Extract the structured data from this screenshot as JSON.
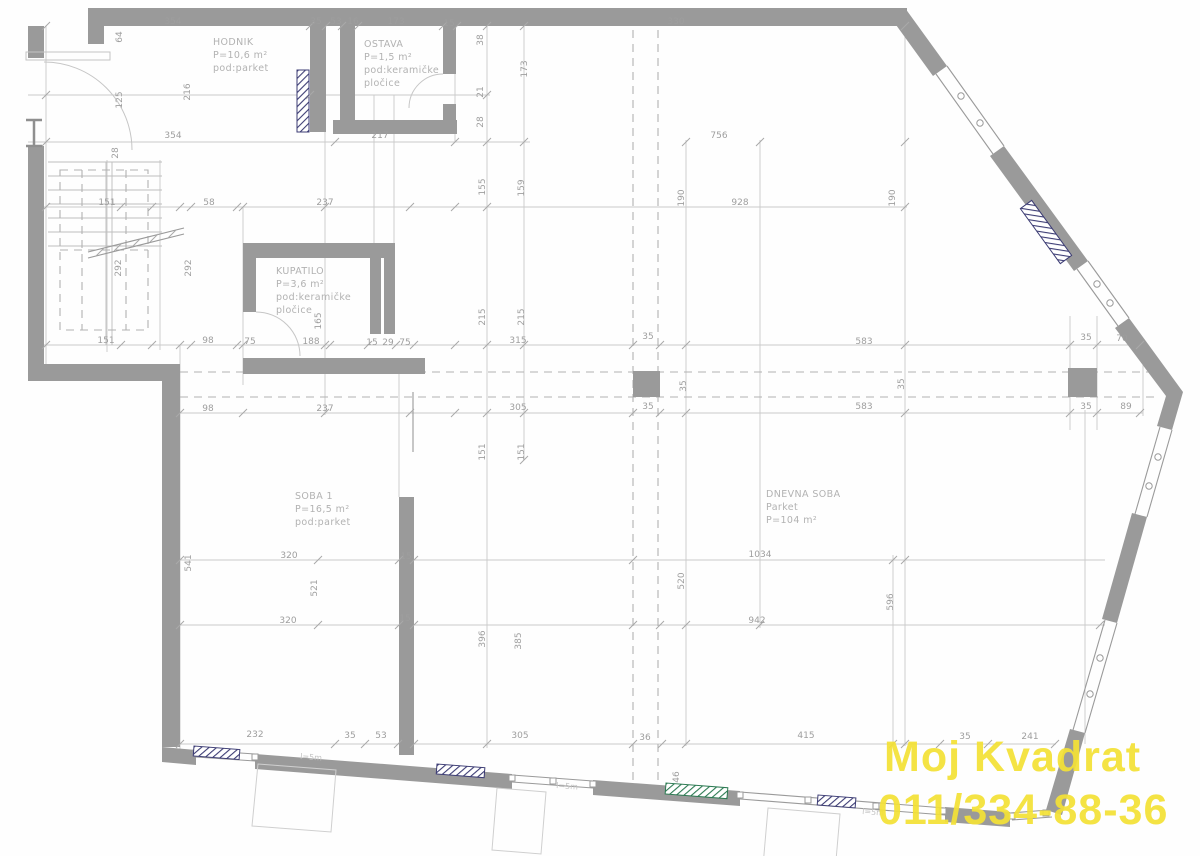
{
  "drawing": {
    "watermark": {
      "line1": "Moj Kvadrat",
      "line2": "011/334-88-36",
      "color": "#f4e136"
    },
    "rooms": [
      {
        "name": "hodnik",
        "x": 213,
        "y": 45,
        "lines": [
          "HODNIK",
          "P=10,6 m²",
          "pod:parket"
        ]
      },
      {
        "name": "ostava",
        "x": 364,
        "y": 47,
        "lines": [
          "OSTAVA",
          "P=1,5 m²",
          "pod:keramičke",
          "pločice"
        ]
      },
      {
        "name": "kupatilo",
        "x": 276,
        "y": 274,
        "lines": [
          "KUPATILO",
          "P=3,6 m²",
          "pod:keramičke",
          "pločice"
        ]
      },
      {
        "name": "soba-1",
        "x": 295,
        "y": 499,
        "lines": [
          "SOBA 1",
          "P=16,5 m²",
          "pod:parket"
        ]
      },
      {
        "name": "dnevna-soba",
        "x": 766,
        "y": 497,
        "lines": [
          "DNEVNA SOBA",
          "Parket",
          "P=104 m²"
        ]
      }
    ],
    "window_labels": [
      {
        "t": "l=5m",
        "x": 300,
        "y": 759,
        "r": 4
      },
      {
        "t": "l=5m",
        "x": 556,
        "y": 788,
        "r": 4
      },
      {
        "t": "l=5m",
        "x": 862,
        "y": 814,
        "r": 4
      }
    ],
    "dimensions": [
      {
        "t": "354",
        "x": 173,
        "y": 24,
        "r": 0
      },
      {
        "t": "35",
        "x": 316,
        "y": 24,
        "r": 0
      },
      {
        "t": "53",
        "x": 336,
        "y": 24,
        "r": 0
      },
      {
        "t": "16",
        "x": 353,
        "y": 24,
        "r": 0
      },
      {
        "t": "173",
        "x": 396,
        "y": 24,
        "r": 0
      },
      {
        "t": "15",
        "x": 449,
        "y": 26,
        "r": 0
      },
      {
        "t": "330",
        "x": 676,
        "y": 24,
        "r": 0
      },
      {
        "t": "64",
        "x": 122,
        "y": 37,
        "r": -90
      },
      {
        "t": "125",
        "x": 122,
        "y": 100,
        "r": -90
      },
      {
        "t": "216",
        "x": 190,
        "y": 92,
        "r": -90
      },
      {
        "t": "28",
        "x": 118,
        "y": 153,
        "r": -90
      },
      {
        "t": "354",
        "x": 173,
        "y": 138,
        "r": 0
      },
      {
        "t": "217",
        "x": 380,
        "y": 138,
        "r": 0
      },
      {
        "t": "756",
        "x": 719,
        "y": 138,
        "r": 0
      },
      {
        "t": "38",
        "x": 483,
        "y": 40,
        "r": -90
      },
      {
        "t": "21",
        "x": 483,
        "y": 92,
        "r": -90
      },
      {
        "t": "28",
        "x": 483,
        "y": 122,
        "r": -90
      },
      {
        "t": "173",
        "x": 527,
        "y": 69,
        "r": -90
      },
      {
        "t": "151",
        "x": 107,
        "y": 205,
        "r": 0
      },
      {
        "t": "58",
        "x": 209,
        "y": 205,
        "r": 0
      },
      {
        "t": "237",
        "x": 325,
        "y": 205,
        "r": 0
      },
      {
        "t": "928",
        "x": 740,
        "y": 205,
        "r": 0
      },
      {
        "t": "190",
        "x": 684,
        "y": 198,
        "r": -90
      },
      {
        "t": "190",
        "x": 895,
        "y": 198,
        "r": -90
      },
      {
        "t": "292",
        "x": 121,
        "y": 268,
        "r": -90
      },
      {
        "t": "292",
        "x": 191,
        "y": 268,
        "r": -90
      },
      {
        "t": "155",
        "x": 485,
        "y": 187,
        "r": -90
      },
      {
        "t": "159",
        "x": 524,
        "y": 188,
        "r": -90
      },
      {
        "t": "215",
        "x": 485,
        "y": 317,
        "r": -90
      },
      {
        "t": "215",
        "x": 524,
        "y": 317,
        "r": -90
      },
      {
        "t": "165",
        "x": 321,
        "y": 321,
        "r": -90
      },
      {
        "t": "151",
        "x": 106,
        "y": 343,
        "r": 0
      },
      {
        "t": "98",
        "x": 208,
        "y": 343,
        "r": 0
      },
      {
        "t": "75",
        "x": 250,
        "y": 344,
        "r": 0
      },
      {
        "t": "188",
        "x": 311,
        "y": 344,
        "r": 0
      },
      {
        "t": "15",
        "x": 372,
        "y": 345,
        "r": 0
      },
      {
        "t": "29",
        "x": 388,
        "y": 345,
        "r": 0
      },
      {
        "t": "75",
        "x": 405,
        "y": 345,
        "r": 0
      },
      {
        "t": "315",
        "x": 518,
        "y": 343,
        "r": 0
      },
      {
        "t": "35",
        "x": 648,
        "y": 339,
        "r": 0
      },
      {
        "t": "583",
        "x": 864,
        "y": 344,
        "r": 0
      },
      {
        "t": "35",
        "x": 1086,
        "y": 340,
        "r": 0
      },
      {
        "t": "70",
        "x": 1122,
        "y": 341,
        "r": 0
      },
      {
        "t": "35",
        "x": 686,
        "y": 386,
        "r": -90
      },
      {
        "t": "35",
        "x": 904,
        "y": 384,
        "r": -90
      },
      {
        "t": "98",
        "x": 208,
        "y": 411,
        "r": 0
      },
      {
        "t": "237",
        "x": 325,
        "y": 411,
        "r": 0
      },
      {
        "t": "305",
        "x": 518,
        "y": 410,
        "r": 0
      },
      {
        "t": "35",
        "x": 648,
        "y": 409,
        "r": 0
      },
      {
        "t": "583",
        "x": 864,
        "y": 409,
        "r": 0
      },
      {
        "t": "35",
        "x": 1086,
        "y": 409,
        "r": 0
      },
      {
        "t": "89",
        "x": 1126,
        "y": 409,
        "r": 0
      },
      {
        "t": "151",
        "x": 485,
        "y": 452,
        "r": -90
      },
      {
        "t": "151",
        "x": 524,
        "y": 452,
        "r": -90
      },
      {
        "t": "541",
        "x": 191,
        "y": 563,
        "r": -90
      },
      {
        "t": "320",
        "x": 289,
        "y": 558,
        "r": 0
      },
      {
        "t": "521",
        "x": 317,
        "y": 588,
        "r": -90
      },
      {
        "t": "15",
        "x": 406,
        "y": 559,
        "r": 0
      },
      {
        "t": "1034",
        "x": 760,
        "y": 557,
        "r": 0
      },
      {
        "t": "520",
        "x": 684,
        "y": 581,
        "r": -90
      },
      {
        "t": "596",
        "x": 893,
        "y": 602,
        "r": -90
      },
      {
        "t": "320",
        "x": 288,
        "y": 623,
        "r": 0
      },
      {
        "t": "942",
        "x": 757,
        "y": 623,
        "r": 0
      },
      {
        "t": "15",
        "x": 405,
        "y": 621,
        "r": 0
      },
      {
        "t": "396",
        "x": 485,
        "y": 639,
        "r": -90
      },
      {
        "t": "385",
        "x": 521,
        "y": 641,
        "r": -90
      },
      {
        "t": "232",
        "x": 255,
        "y": 737,
        "r": 0
      },
      {
        "t": "35",
        "x": 350,
        "y": 738,
        "r": 0
      },
      {
        "t": "53",
        "x": 381,
        "y": 738,
        "r": 0
      },
      {
        "t": "305",
        "x": 520,
        "y": 738,
        "r": 0
      },
      {
        "t": "36",
        "x": 645,
        "y": 740,
        "r": 0
      },
      {
        "t": "415",
        "x": 806,
        "y": 738,
        "r": 0
      },
      {
        "t": "35",
        "x": 965,
        "y": 739,
        "r": 0
      },
      {
        "t": "241",
        "x": 1030,
        "y": 739,
        "r": 0
      },
      {
        "t": "46",
        "x": 679,
        "y": 777,
        "r": -90
      }
    ]
  }
}
